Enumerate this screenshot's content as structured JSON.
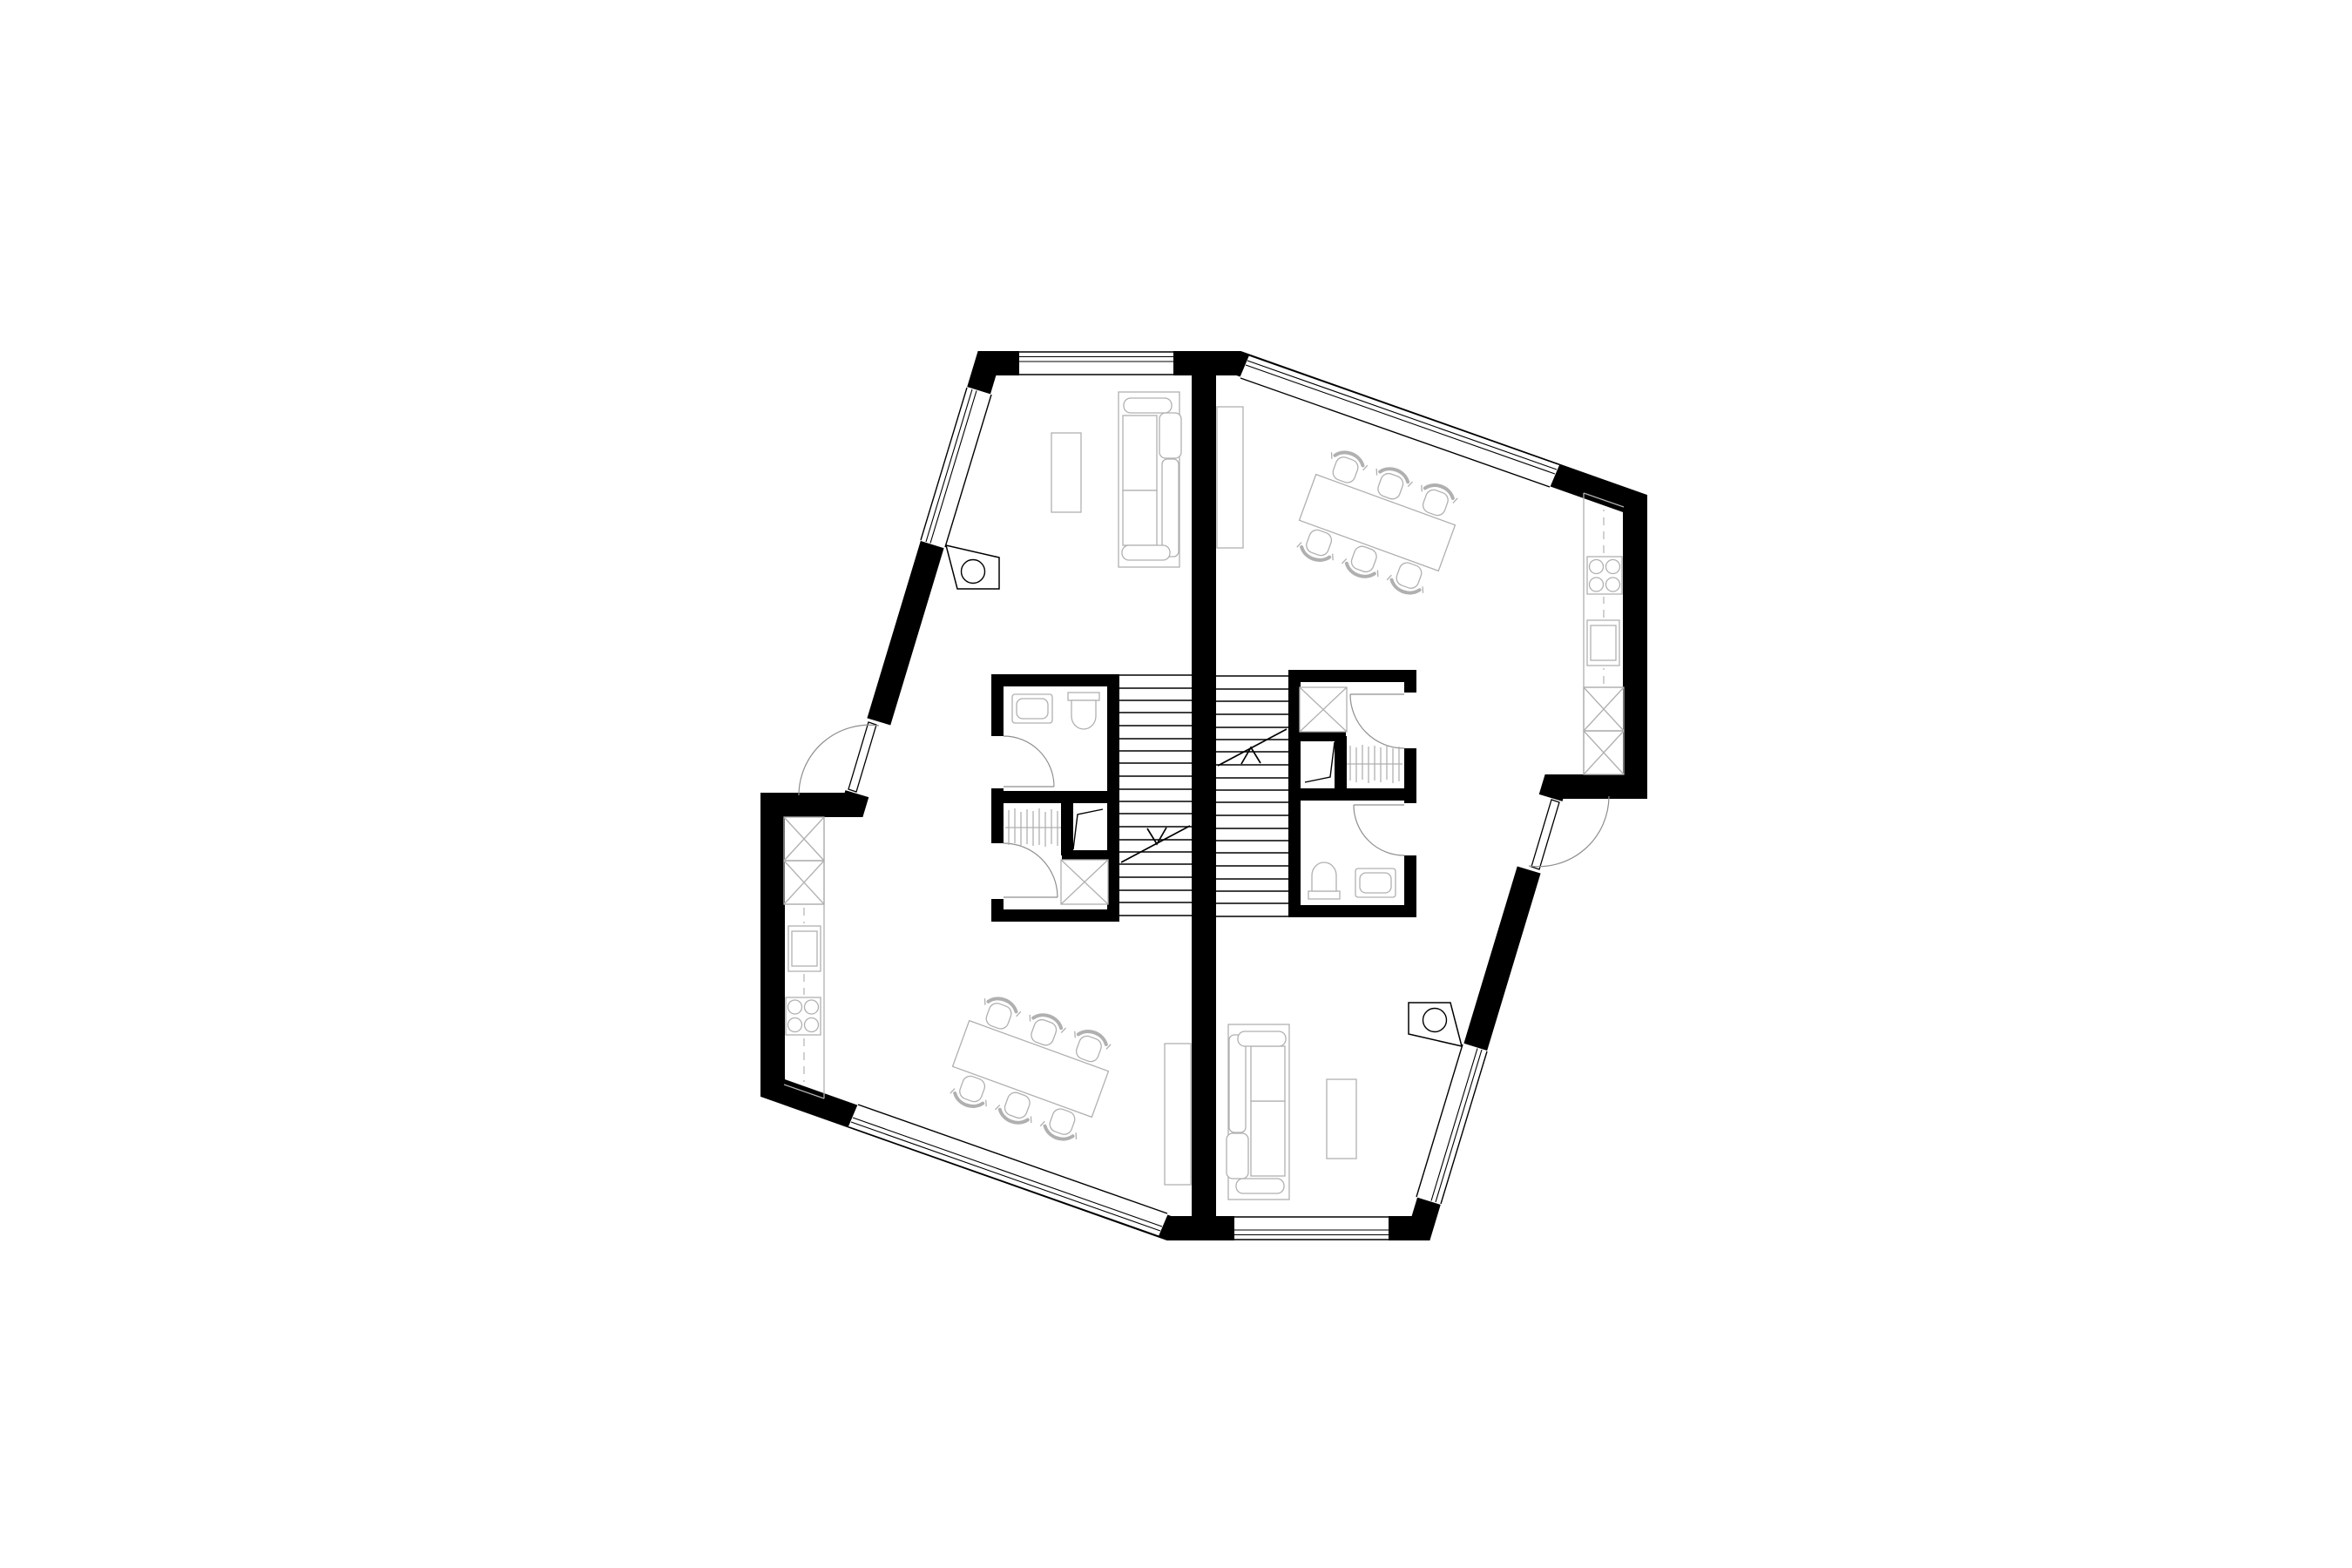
{
  "document": {
    "title": "Floor plan — mirrored duplex, two apartments with central stair core",
    "type": "architectural-floor-plan",
    "visible_text": "none"
  },
  "colors": {
    "background": "#ffffff",
    "wall": "#000000",
    "furniture": "#b0b0b0",
    "door": "#8f8f8f"
  },
  "plan": {
    "symmetry": "point-mirrored (180 degrees) about center of party wall",
    "shared": {
      "party_wall": "vertical central wall between units",
      "staircase": {
        "flights": 2,
        "treads_per_flight": 20,
        "direction_arrows": 2
      }
    },
    "units": [
      {
        "id": "unit-a",
        "position": "left / lower",
        "rooms": [
          {
            "name": "living-room",
            "location": "top-left",
            "furniture": [
              "sofa",
              "coffee-table"
            ]
          },
          {
            "name": "dining-room",
            "location": "bottom-left",
            "furniture": [
              "dining-table",
              "6 chairs",
              "sideboard"
            ]
          },
          {
            "name": "kitchen",
            "location": "west wall",
            "fittings": [
              "tall-cabinet",
              "tall-cabinet",
              "sink",
              "hob-4-burners",
              "counter"
            ]
          },
          {
            "name": "bathroom",
            "location": "core top",
            "fittings": [
              "washbasin",
              "toilet",
              "door"
            ]
          },
          {
            "name": "wardrobe",
            "location": "core bottom",
            "fittings": [
              "hanging-rail",
              "closet",
              "appliance-box",
              "door"
            ]
          }
        ],
        "openings": [
          "entry-door on west slanted wall",
          "window north",
          "window north-west slant",
          "window south-west slant"
        ]
      },
      {
        "id": "unit-b",
        "position": "right / upper (mirror of unit-a)",
        "rooms": [
          {
            "name": "dining-room",
            "location": "top-right",
            "furniture": [
              "dining-table",
              "6 chairs",
              "sideboard"
            ]
          },
          {
            "name": "living-room",
            "location": "bottom-right",
            "furniture": [
              "sofa",
              "coffee-table"
            ]
          },
          {
            "name": "kitchen",
            "location": "east wall",
            "fittings": [
              "tall-cabinet",
              "tall-cabinet",
              "sink",
              "hob-4-burners",
              "counter"
            ]
          },
          {
            "name": "bathroom",
            "location": "core bottom",
            "fittings": [
              "washbasin",
              "toilet",
              "door"
            ]
          },
          {
            "name": "wardrobe",
            "location": "core top",
            "fittings": [
              "hanging-rail",
              "closet",
              "appliance-box",
              "door"
            ]
          }
        ],
        "openings": [
          "entry-door on east slanted wall",
          "window south",
          "window south-east slant",
          "window north-east slant"
        ]
      }
    ],
    "details": [
      "two exterior column elements with round pipe section, one per unit"
    ]
  }
}
